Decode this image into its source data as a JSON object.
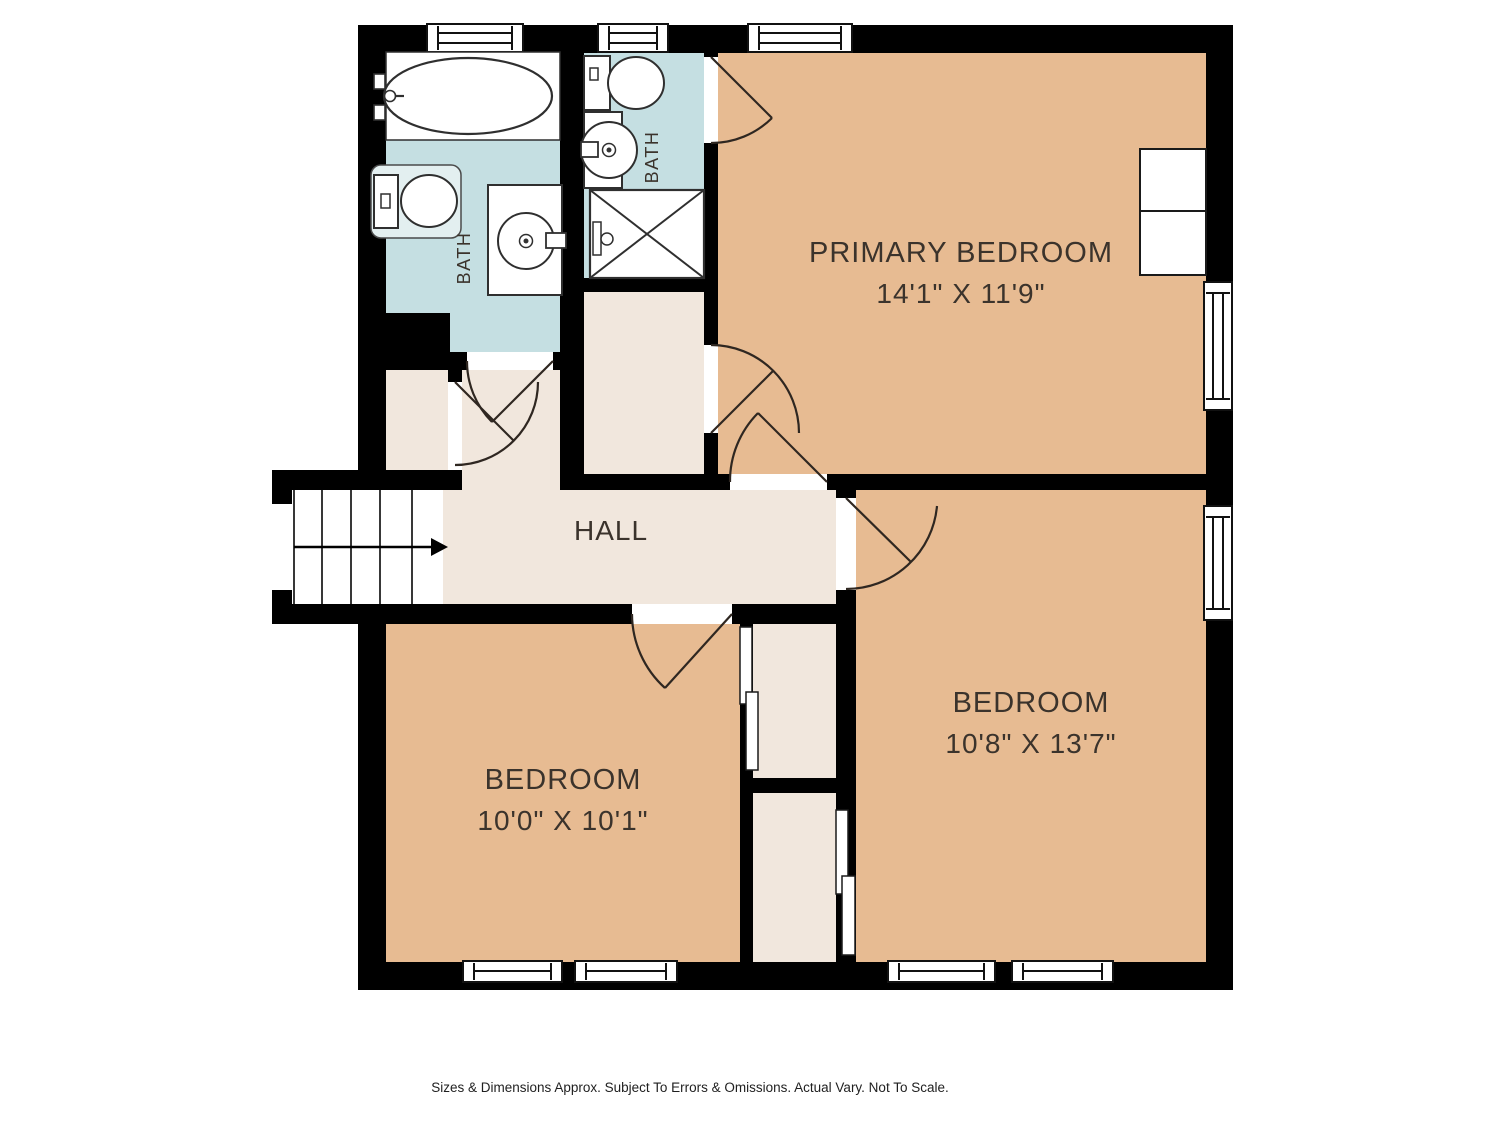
{
  "colors": {
    "wall": "#000000",
    "bath_floor": "#c5dfe2",
    "bedroom_floor": "#e7bb92",
    "hall_floor": "#f1e7dd",
    "fixture_mat": "#e3eff0",
    "line": "#2f2721",
    "label": "#3b332c",
    "disclaimer_color": "#1f1f1f"
  },
  "rooms": {
    "primary_bedroom": {
      "name": "PRIMARY BEDROOM",
      "dims": "14'1\" X 11'9\""
    },
    "bedroom_left": {
      "name": "BEDROOM",
      "dims": "10'0\" X 10'1\""
    },
    "bedroom_right": {
      "name": "BEDROOM",
      "dims": "10'8\" X 13'7\""
    },
    "hall": {
      "name": "HALL"
    },
    "bath_main": {
      "label": "BATH"
    },
    "bath_ensuite": {
      "label": "BATH"
    }
  },
  "footer": {
    "disclaimer": "Sizes & Dimensions Approx. Subject To Errors & Omissions. Actual Vary. Not To Scale."
  }
}
